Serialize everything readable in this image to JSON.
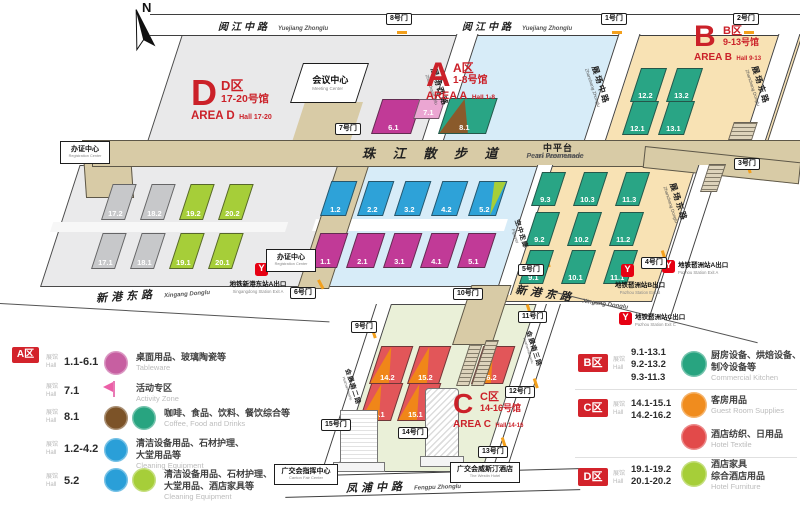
{
  "compass": {
    "label": "N"
  },
  "colors": {
    "accent_red": "#cb2129",
    "badge_red": "#d3232b",
    "metro_red": "#e60012",
    "area_a_bg": "#d7ecf8",
    "area_b_bg": "#f8e2b4",
    "area_c_bg": "#eaf0d8",
    "area_d_bg": "#e9e9ea",
    "walkway": "#d8cba6",
    "hall_gray": "#c7c8ca",
    "hall_lime": "#a6ce39",
    "hall_magenta": "#c13a97",
    "hall_pink": "#eba6d2",
    "hall_blue": "#2ea2d8",
    "hall_green": "#29a585",
    "hall_orange": "#f08619",
    "hall_red": "#e25659",
    "hall_brown": "#8a5a2b"
  },
  "map": {
    "areas": [
      {
        "id": "A",
        "letter": "A",
        "zh": "A区",
        "halls_zh": "1-8号馆",
        "en": "AREA A",
        "halls_en": "Hall 1-8"
      },
      {
        "id": "B",
        "letter": "B",
        "zh": "B区",
        "halls_zh": "9-13号馆",
        "en": "AREA B",
        "halls_en": "Hall 9-13"
      },
      {
        "id": "C",
        "letter": "C",
        "zh": "C区",
        "halls_zh": "14-16号馆",
        "en": "AREA C",
        "halls_en": "Hall 14-16"
      },
      {
        "id": "D",
        "letter": "D",
        "zh": "D区",
        "halls_zh": "17-20号馆",
        "en": "AREA D",
        "halls_en": "Hall 17-20"
      }
    ],
    "roads": [
      {
        "id": "yuejiang-left",
        "zh": "阅江中路",
        "en": "Yuejiang Zhonglu"
      },
      {
        "id": "yuejiang-right",
        "zh": "阅江中路",
        "en": "Yuejiang Zhonglu"
      },
      {
        "id": "zhanchang-xilu",
        "zh": "展场西路",
        "en": "Zhanchang Xilu"
      },
      {
        "id": "zhanchang-zhonglu",
        "zh": "展场中路",
        "en": "Zhanchang Zhonglu"
      },
      {
        "id": "zhanchang-donglu-top",
        "zh": "展场东路",
        "en": "Zhanchang Donglu"
      },
      {
        "id": "zhanchang-donglu",
        "zh": "展场东路",
        "en": "Zhanchang Donglu"
      },
      {
        "id": "flyover",
        "zh": "空中走廊",
        "en": "Flyover"
      },
      {
        "id": "pearl-promenade",
        "zh": "珠 江 散 步 道",
        "en": "Pearl Promenade"
      },
      {
        "id": "middle-platform",
        "zh": "中平台",
        "en": "The Middle Platform"
      },
      {
        "id": "xingang-donglu-left",
        "zh": "新港东路",
        "en": "Xingang Donglu"
      },
      {
        "id": "xingang-donglu-right",
        "zh": "新港东路",
        "en": "Xingang Donglu"
      },
      {
        "id": "huizhannan-erlu",
        "zh": "会展南二路",
        "en": "Huizhannanerlu"
      },
      {
        "id": "huizhannan-sanlu",
        "zh": "会展南三路",
        "en": "Huizhannansanlu"
      },
      {
        "id": "fengpu-zhonglu",
        "zh": "凤浦中路",
        "en": "Fengpu Zhonglu"
      }
    ],
    "halls": [
      {
        "label": "17.2",
        "color": "gray"
      },
      {
        "label": "18.2",
        "color": "gray"
      },
      {
        "label": "19.2",
        "color": "lime"
      },
      {
        "label": "20.2",
        "color": "lime"
      },
      {
        "label": "17.1",
        "color": "gray"
      },
      {
        "label": "18.1",
        "color": "gray"
      },
      {
        "label": "19.1",
        "color": "lime"
      },
      {
        "label": "20.1",
        "color": "lime"
      },
      {
        "label": "6.1",
        "color": "magenta"
      },
      {
        "label": "7.1",
        "color": "pink"
      },
      {
        "label": "8.1",
        "color": "duoBG"
      },
      {
        "label": "1.2",
        "color": "blue"
      },
      {
        "label": "2.2",
        "color": "blue"
      },
      {
        "label": "3.2",
        "color": "blue"
      },
      {
        "label": "4.2",
        "color": "blue"
      },
      {
        "label": "5.2",
        "color": "duoBL"
      },
      {
        "label": "1.1",
        "color": "magenta"
      },
      {
        "label": "2.1",
        "color": "magenta"
      },
      {
        "label": "3.1",
        "color": "magenta"
      },
      {
        "label": "4.1",
        "color": "magenta"
      },
      {
        "label": "5.1",
        "color": "magenta"
      },
      {
        "label": "12.2",
        "color": "green"
      },
      {
        "label": "13.2",
        "color": "green"
      },
      {
        "label": "12.1",
        "color": "green"
      },
      {
        "label": "13.1",
        "color": "green"
      },
      {
        "label": "9.3",
        "color": "green"
      },
      {
        "label": "10.3",
        "color": "green"
      },
      {
        "label": "11.3",
        "color": "green"
      },
      {
        "label": "9.2",
        "color": "green"
      },
      {
        "label": "10.2",
        "color": "green"
      },
      {
        "label": "11.2",
        "color": "green"
      },
      {
        "label": "9.1",
        "color": "green"
      },
      {
        "label": "10.1",
        "color": "green"
      },
      {
        "label": "11.1",
        "color": "green"
      },
      {
        "label": "14.2",
        "color": "duoOR"
      },
      {
        "label": "15.2",
        "color": "duoOR"
      },
      {
        "label": "16.2",
        "color": "duoOR"
      },
      {
        "label": "14.1",
        "color": "duoOR"
      },
      {
        "label": "15.1",
        "color": "duoOR"
      }
    ],
    "gates": [
      {
        "id": "gate-1",
        "label": "1号门"
      },
      {
        "id": "gate-2",
        "label": "2号门"
      },
      {
        "id": "gate-3",
        "label": "3号门"
      },
      {
        "id": "gate-4",
        "label": "4号门"
      },
      {
        "id": "gate-5",
        "label": "5号门"
      },
      {
        "id": "gate-6",
        "label": "6号门"
      },
      {
        "id": "gate-7",
        "label": "7号门"
      },
      {
        "id": "gate-8",
        "label": "8号门"
      },
      {
        "id": "gate-9",
        "label": "9号门"
      },
      {
        "id": "gate-10",
        "label": "10号门"
      },
      {
        "id": "gate-11",
        "label": "11号门"
      },
      {
        "id": "gate-12",
        "label": "12号门"
      },
      {
        "id": "gate-13",
        "label": "13号门"
      },
      {
        "id": "gate-14",
        "label": "14号门"
      },
      {
        "id": "gate-15",
        "label": "15号门"
      }
    ],
    "metro_exits": [
      {
        "id": "xingangdong-a",
        "zh": "地铁新港东站A出口",
        "en": "Xingangdong Station Exit A"
      },
      {
        "id": "pazhou-b",
        "zh": "地铁琶洲站B出口",
        "en": "Pazhou Station Exit B"
      },
      {
        "id": "pazhou-a",
        "zh": "地铁琶洲站A出口",
        "en": "Pazhou Station Exit A"
      },
      {
        "id": "pazhou-c",
        "zh": "地铁琶洲站C出口",
        "en": "Pazhou Station Exit C"
      }
    ],
    "facilities": [
      {
        "id": "meeting-center",
        "zh": "会议中心",
        "en": "Meeting Center"
      },
      {
        "id": "registration-west",
        "zh": "办证中心",
        "en": "Registration Center"
      },
      {
        "id": "registration-mid",
        "zh": "办证中心",
        "en": "Registration Center"
      },
      {
        "id": "canton-fair-center",
        "zh": "广交会指挥中心",
        "en": "Canton Fair Center"
      },
      {
        "id": "westin-hotel",
        "zh": "广交会威斯汀酒店",
        "en": "The Westin Hotel"
      }
    ]
  },
  "legend": {
    "hall_zh": "展馆",
    "hall_en": "Hall",
    "left": {
      "badge": "A区",
      "rows": [
        {
          "halls": "1.1-6.1",
          "icons": [
            "tableware"
          ],
          "zh": "桌面用品、玻璃陶瓷等",
          "en": "Tableware"
        },
        {
          "halls": "7.1",
          "icons": [
            "flag"
          ],
          "zh": "活动专区",
          "en": "Activity Zone"
        },
        {
          "halls": "8.1",
          "icons": [
            "coffee",
            "kitchen"
          ],
          "zh": "咖啡、食品、饮料、餐饮综合等",
          "en": "Coffee, Food and Drinks"
        },
        {
          "halls": "1.2-4.2",
          "icons": [
            "clean"
          ],
          "zh": "清洁设备用品、石材护理、\n大堂用品等",
          "en": "Cleaning Equipment"
        },
        {
          "halls": "5.2",
          "icons": [
            "clean",
            "furniture"
          ],
          "zh": "清洁设备用品、石材护理、\n大堂用品、酒店家具等",
          "en": "Cleaning Equipment"
        }
      ]
    },
    "right": [
      {
        "badge": "B区",
        "halls": [
          "9.1-13.1",
          "9.2-13.2",
          "9.3-11.3"
        ],
        "rows": [
          {
            "icons": [
              "kitchen"
            ],
            "zh": "厨房设备、烘焙设备、\n制冷设备等",
            "en": "Commercial Kitchen"
          }
        ]
      },
      {
        "badge": "C区",
        "halls": [
          "14.1-15.1",
          "14.2-16.2"
        ],
        "rows": [
          {
            "icons": [
              "guestroom"
            ],
            "zh": "客房用品",
            "en": "Guest Room Supplies"
          },
          {
            "icons": [
              "textile"
            ],
            "zh": "酒店纺织、日用品",
            "en": "Hotel Textile"
          }
        ]
      },
      {
        "badge": "D区",
        "halls": [
          "19.1-19.2",
          "20.1-20.2"
        ],
        "rows": [
          {
            "icons": [
              "furniture"
            ],
            "zh": "酒店家具\n综合酒店用品",
            "en": "Hotel Furniture"
          }
        ]
      }
    ],
    "icon_colors": {
      "tableware": "#c75fa1",
      "coffee": "#7c5328",
      "kitchen": "#28a480",
      "clean": "#2a9fd8",
      "guestroom": "#f08c1e",
      "textile": "#e24a4a",
      "furniture": "#a6ce39"
    }
  }
}
